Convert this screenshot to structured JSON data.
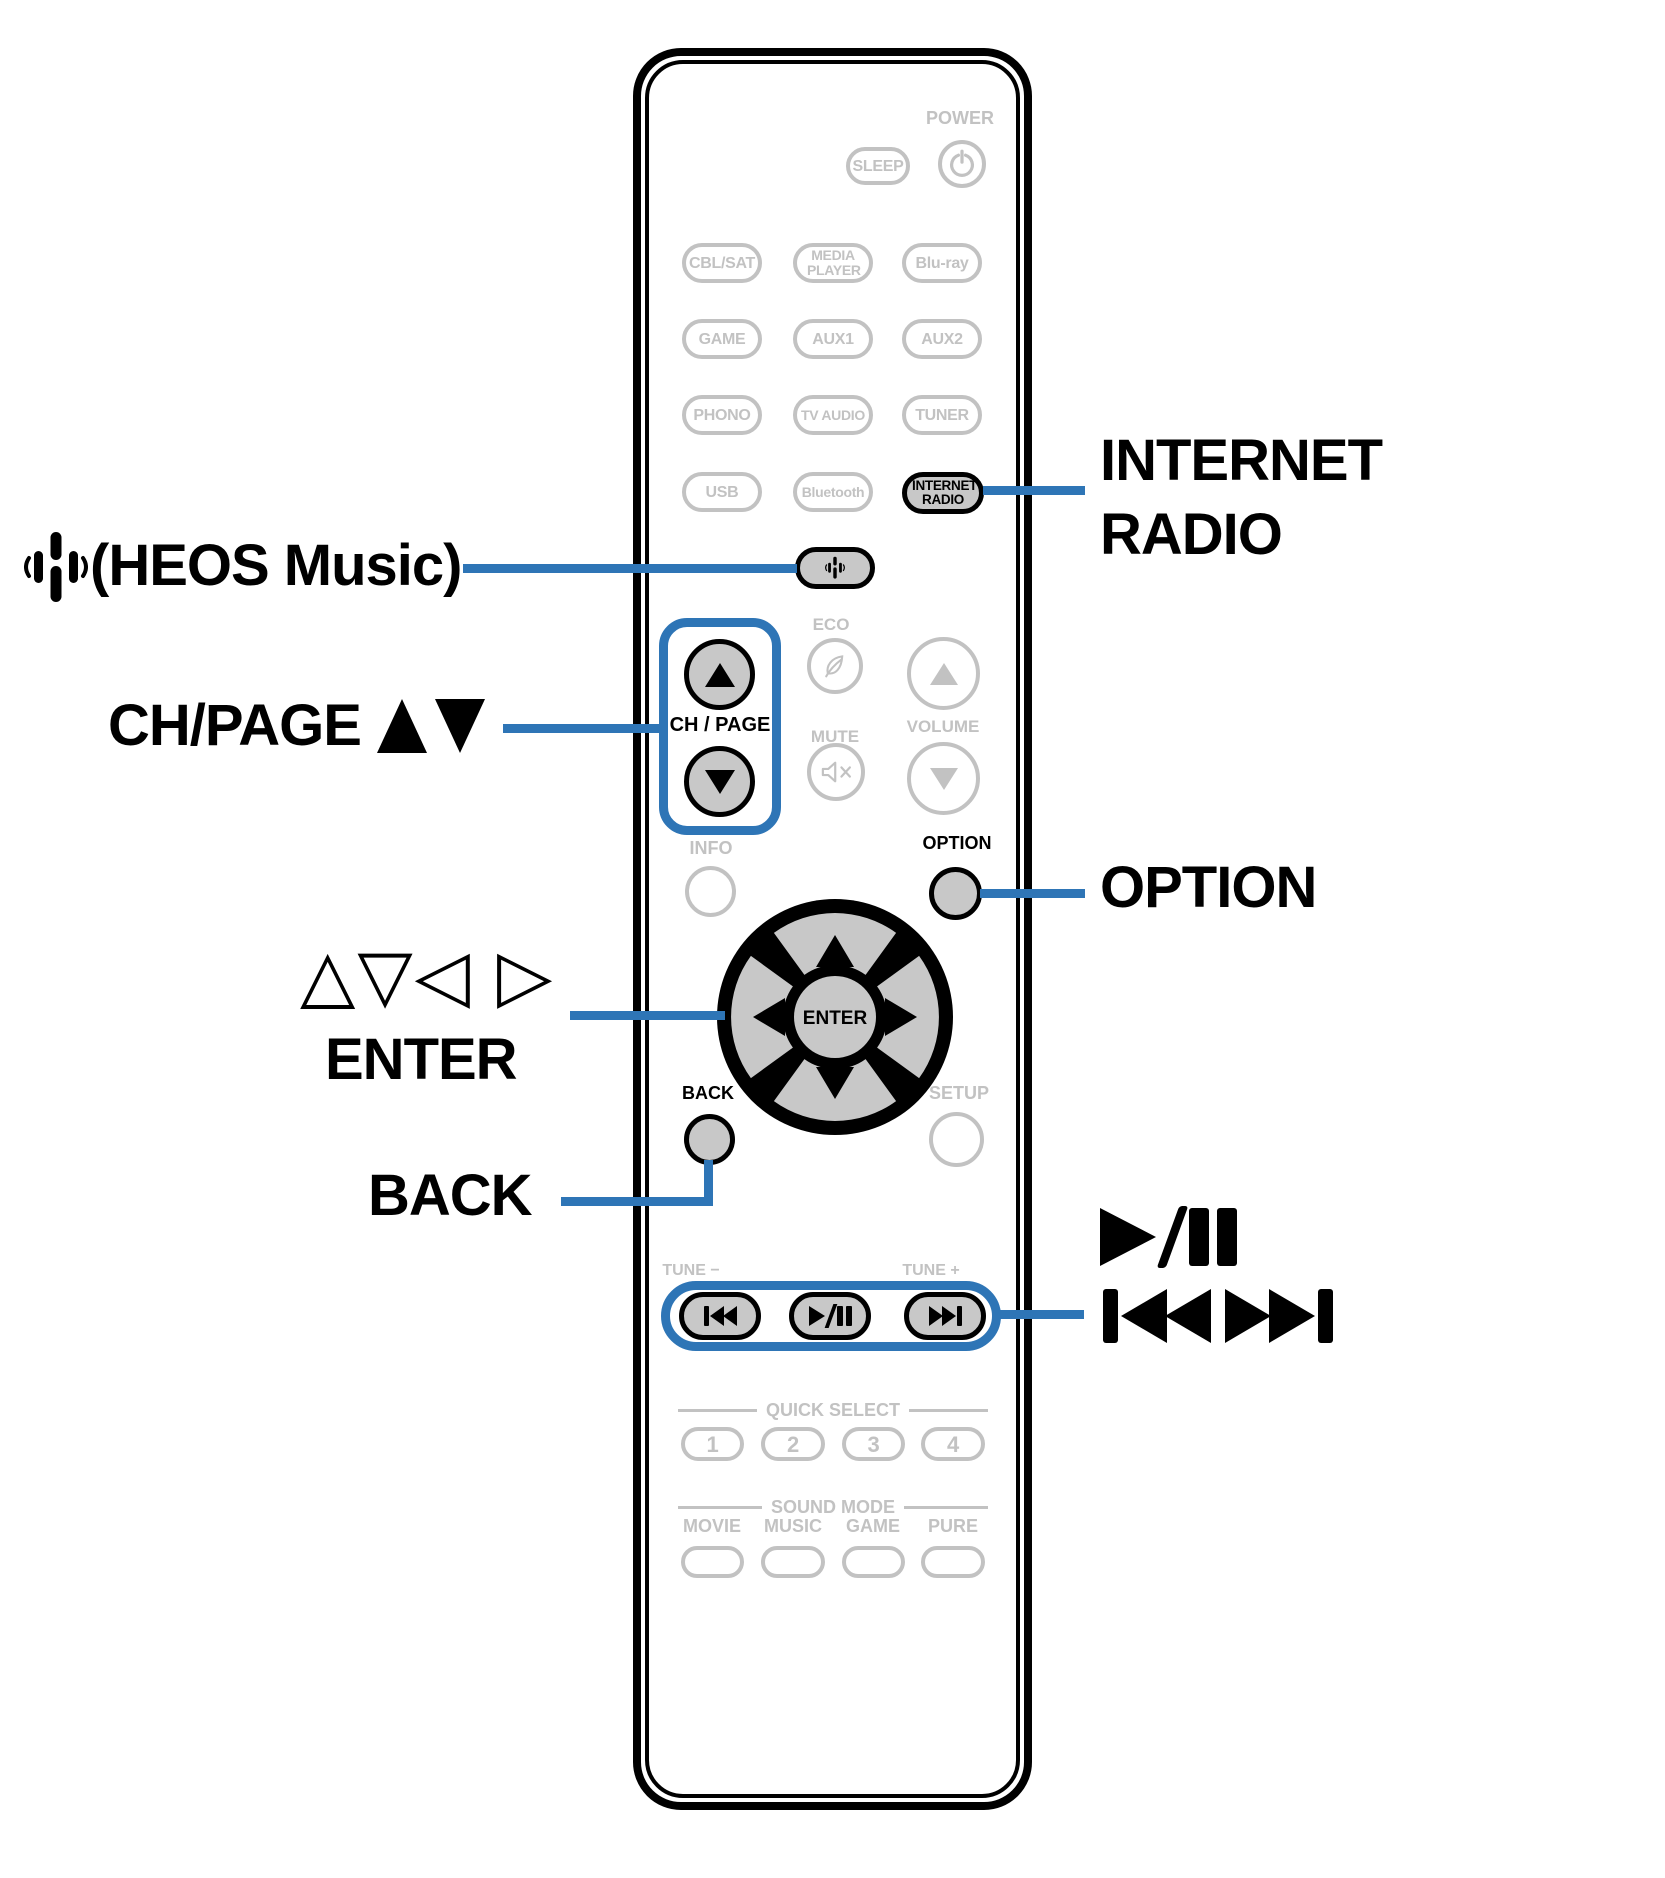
{
  "colors": {
    "accent_blue": "#2e75b6",
    "inactive_gray": "#c2c2c2",
    "button_fill": "#c8c8c8",
    "ink": "#0a0a0a"
  },
  "callouts": {
    "heos": {
      "icon": "heos-icon",
      "label": "(HEOS Music)"
    },
    "ch_page": {
      "label": "CH/PAGE",
      "arrows": "▲▼"
    },
    "cursor_arrows": "△▽◁ ▷",
    "enter": "ENTER",
    "back": "BACK",
    "internet_radio": {
      "line1": "INTERNET",
      "line2": "RADIO"
    },
    "option": "OPTION",
    "transport": {
      "play_pause_icon": "play-pause",
      "skip_icons": "skip-back skip-forward"
    }
  },
  "remote": {
    "power_label": "POWER",
    "sleep": "SLEEP",
    "sources": [
      "CBL/SAT",
      "MEDIA PLAYER",
      "Blu-ray",
      "GAME",
      "AUX1",
      "AUX2",
      "PHONO",
      "TV AUDIO",
      "TUNER",
      "USB",
      "Bluetooth"
    ],
    "internet_radio": "INTERNET RADIO",
    "heos_button_icon": "heos-icon",
    "eco": "ECO",
    "ch_page": "CH / PAGE",
    "mute": "MUTE",
    "volume": "VOLUME",
    "info": "INFO",
    "option": "OPTION",
    "enter": "ENTER",
    "back": "BACK",
    "setup": "SETUP",
    "tune_minus": "TUNE −",
    "tune_plus": "TUNE +",
    "quick_select": {
      "header": "QUICK SELECT",
      "buttons": [
        "1",
        "2",
        "3",
        "4"
      ]
    },
    "sound_mode": {
      "header": "SOUND MODE",
      "labels": [
        "MOVIE",
        "MUSIC",
        "GAME",
        "PURE"
      ]
    }
  }
}
